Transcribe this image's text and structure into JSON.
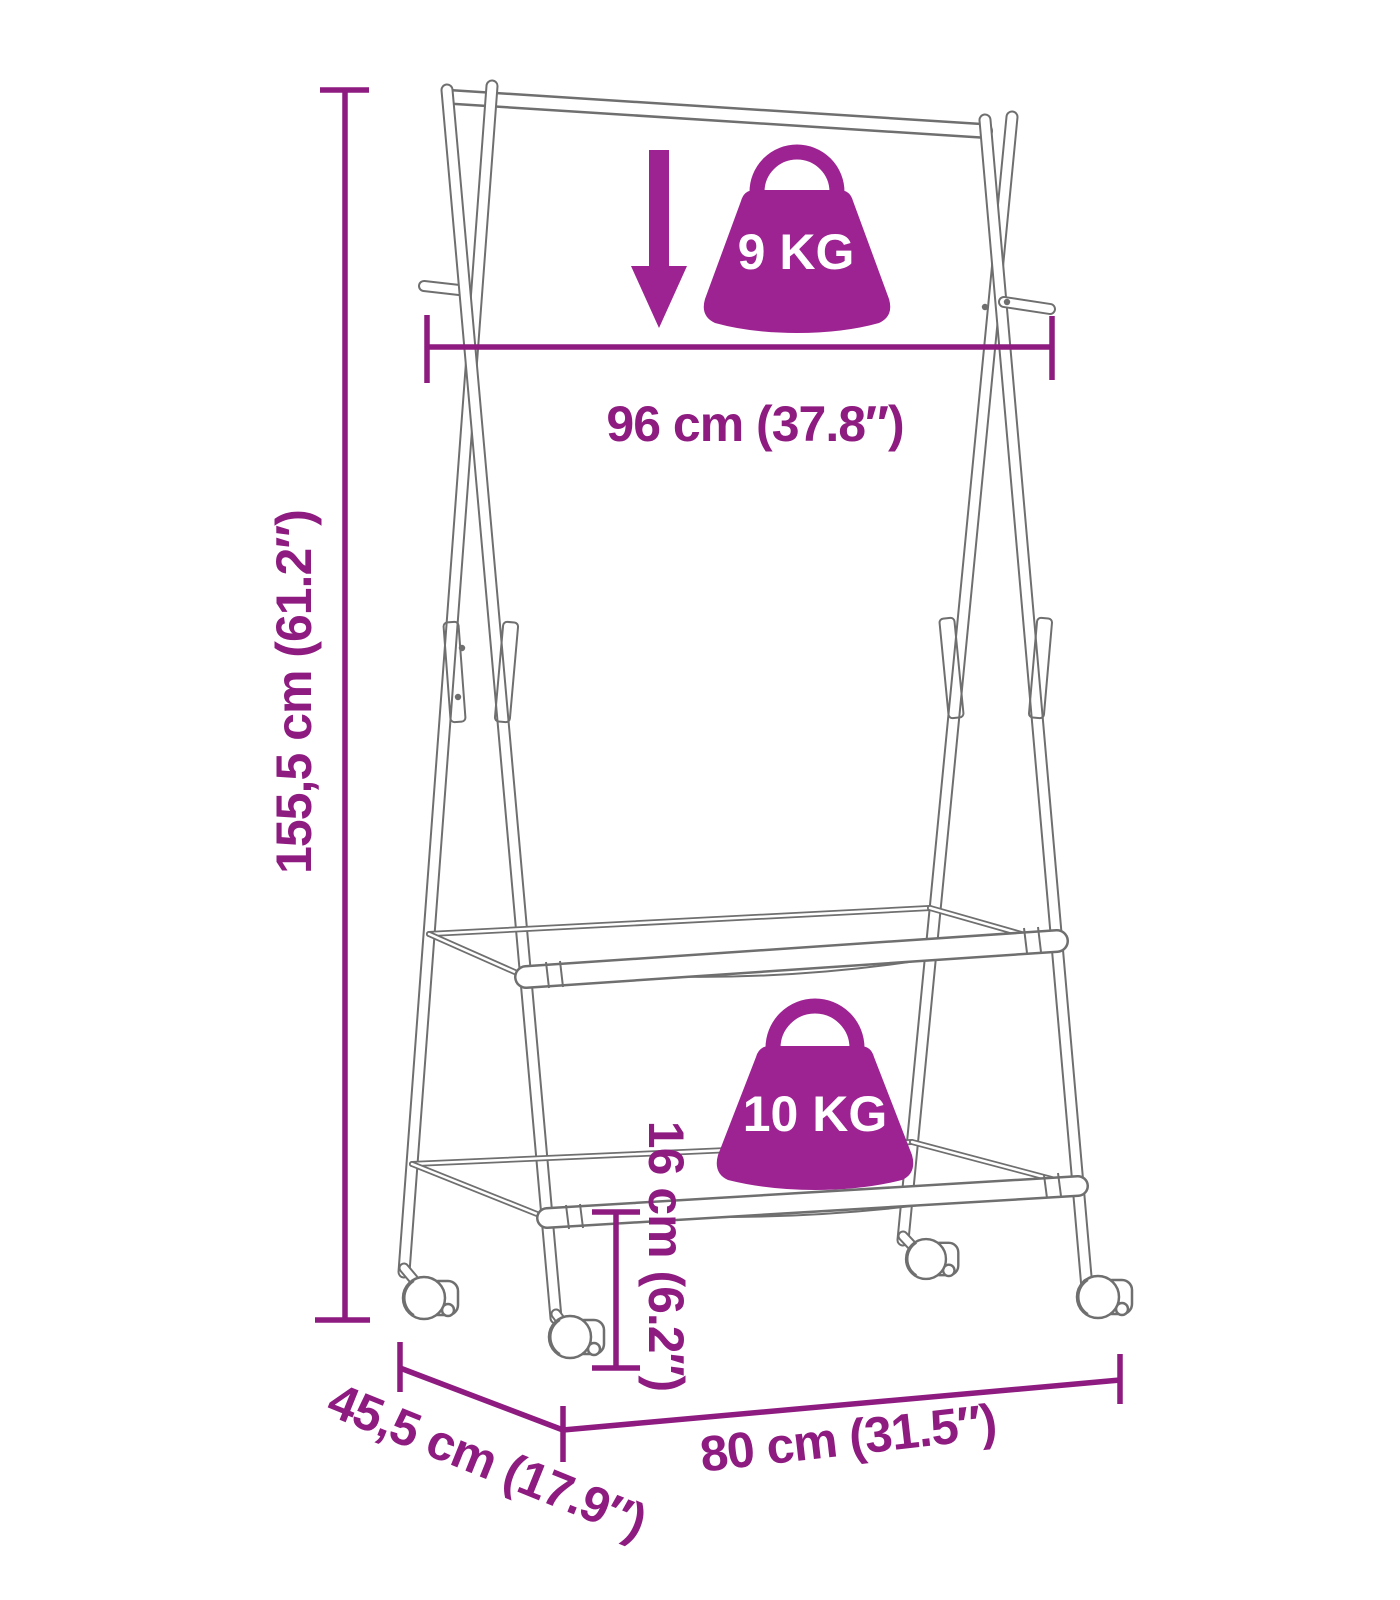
{
  "colors": {
    "background": "#ffffff",
    "accent": "#9d2292",
    "dimension": "#8e1b80",
    "frame_line": "#6f6f6f",
    "badge_text": "#ffffff"
  },
  "diagram": {
    "height_label": "155,5 cm (61.2″)",
    "rail_width_label": "96 cm (37.8″)",
    "rail_capacity_label": "9 KG",
    "shelf_capacity_label": "10 KG",
    "shelf_height_label": "16 cm (6.2″)",
    "depth_label": "45,5 cm (17.9″)",
    "base_width_label": "80 cm (31.5″)"
  }
}
